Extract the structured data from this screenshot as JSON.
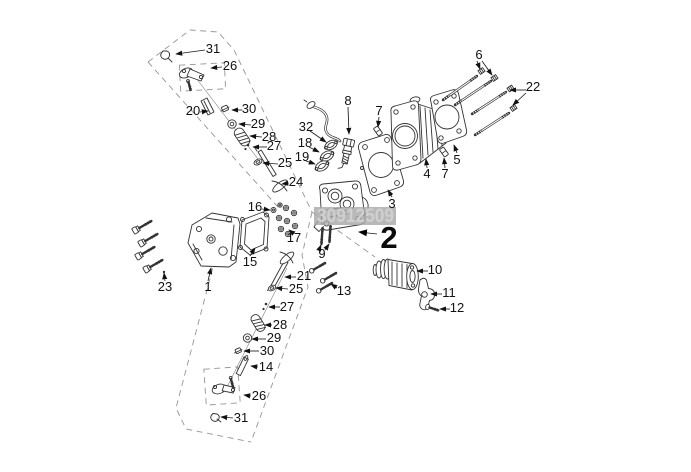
{
  "diagram": {
    "watermark": "30912509",
    "parts": {
      "1": "1",
      "2": "2",
      "3": "3",
      "4": "4",
      "5": "5",
      "6": "6",
      "7": "7",
      "8": "8",
      "9": "9",
      "10": "10",
      "11": "11",
      "12": "12",
      "13": "13",
      "14": "14",
      "15": "15",
      "16": "16",
      "17": "17",
      "18": "18",
      "19": "19",
      "20": "20",
      "21": "21",
      "22": "22",
      "23": "23",
      "24": "24",
      "25": "25",
      "26": "26",
      "27": "27",
      "28": "28",
      "29": "29",
      "30": "30",
      "31": "31",
      "32": "32"
    }
  }
}
